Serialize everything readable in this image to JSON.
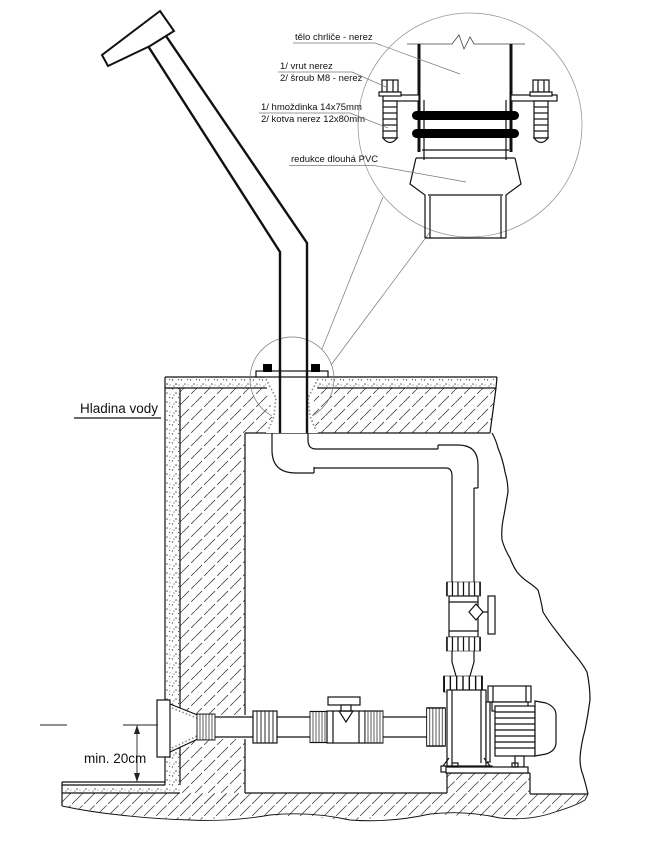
{
  "labels": {
    "detail": {
      "body": "tělo chrliče - nerez",
      "screw_line1": "1/ vrut nerez",
      "screw_line2": "2/ šroub M8 - nerez",
      "anchor_line1": "1/ hmoždinka 14x75mm",
      "anchor_line2": "2/ kotva nerez 12x80mm",
      "reduction": "redukce dlouhá PVC"
    },
    "water_level": "Hladina vody",
    "min_depth": "min. 20cm"
  },
  "colors": {
    "line": "#111111",
    "thin_line": "#777777",
    "background": "#ffffff",
    "seal_band": "#000000"
  }
}
